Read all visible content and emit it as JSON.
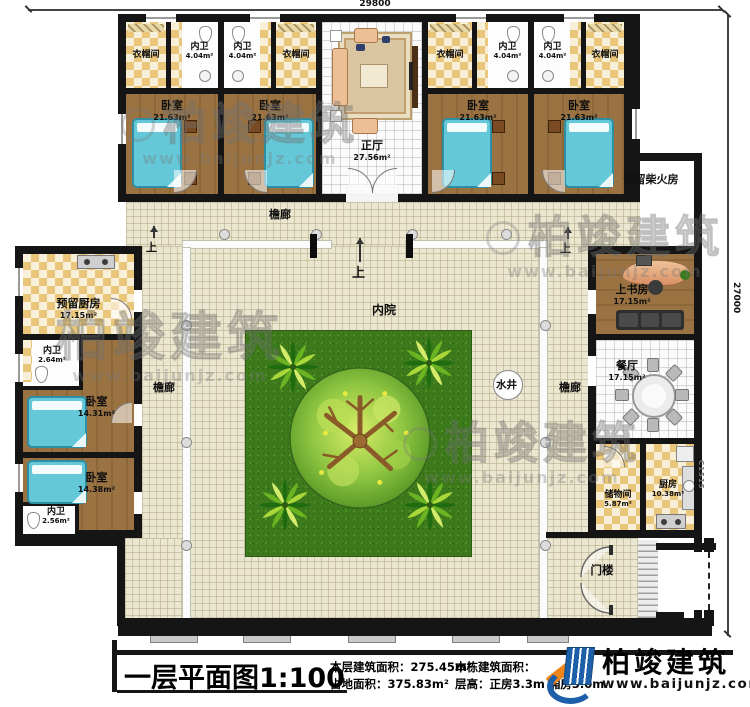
{
  "dimensions": {
    "top_width": "29800",
    "right_height": "27000",
    "window_code": "C1515"
  },
  "marks": {
    "up": "上"
  },
  "rooms": {
    "cloakroom": {
      "name": "衣帽间"
    },
    "bath_404": {
      "name": "内卫",
      "area": "4.04m²"
    },
    "bedroom_2163": {
      "name": "卧室",
      "area": "21.63m²"
    },
    "main_hall": {
      "name": "正厅",
      "area": "27.56m²"
    },
    "firewood_room": {
      "name": "预留柴火房"
    },
    "veranda": {
      "name": "檐廊"
    },
    "reserved_kitchen": {
      "name": "预留厨房",
      "area": "17.15m²"
    },
    "bath_264": {
      "name": "内卫",
      "area": "2.64m²"
    },
    "bedroom_1431": {
      "name": "卧室",
      "area": "14.31m²"
    },
    "bedroom_1438": {
      "name": "卧室",
      "area": "14.38m²"
    },
    "bath_256": {
      "name": "内卫",
      "area": "2.56m²"
    },
    "inner_courtyard": {
      "name": "内院"
    },
    "well": {
      "name": "水井"
    },
    "study": {
      "name": "上书房",
      "area": "17.15m²"
    },
    "dining_room": {
      "name": "餐厅",
      "area": "17.15m²"
    },
    "storage_room": {
      "name": "储物间",
      "area": "5.87m²"
    },
    "kitchen": {
      "name": "厨房",
      "area": "10.38m²"
    },
    "gatehouse": {
      "name": "门楼"
    }
  },
  "title_block": {
    "title": "一层平面图1:100",
    "floor_area_label": "本层建筑面积：",
    "floor_area_value": "275.45m²",
    "site_area_label": "占地面积：",
    "site_area_value": "375.83m²",
    "building_area_label": "本栋建筑面积：",
    "storey_height_label": "层高：",
    "storey_height_value": "正房3.3m 厢房3.0m"
  },
  "brand": {
    "name": "柏竣建筑",
    "url": "www.baijunjz.com"
  },
  "colors": {
    "wall": "#151515",
    "wood_floor": "#96713f",
    "bed_teal": "#64c8d8",
    "lawn": "#3d7a1c",
    "paving": "#ebe6cf",
    "checker": "#e9c67a",
    "logo_blue": "#1d5fa8",
    "logo_orange": "#f08519"
  }
}
